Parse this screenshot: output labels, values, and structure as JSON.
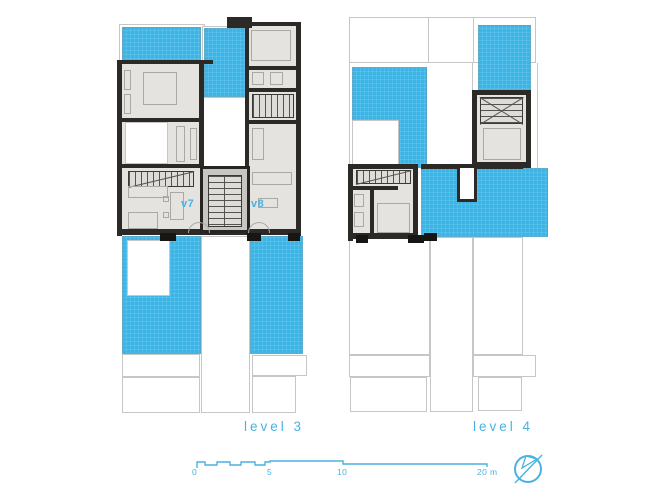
{
  "palette": {
    "terrace_blue": "#3CB4E6",
    "accent": "#49B2E2",
    "wall": "#2B2A27",
    "floor": "#E4E3E0",
    "core": "#C7C6C3",
    "outline": "#C6C6C6",
    "furniture": "#A9A8A4"
  },
  "plans": [
    {
      "label": "level 3",
      "units": [
        {
          "label": "v7"
        },
        {
          "label": "v8"
        }
      ]
    },
    {
      "label": "level 4",
      "units": []
    }
  ],
  "scale_bar": {
    "ticks": [
      {
        "label": "0"
      },
      {
        "label": "5"
      },
      {
        "label": "10"
      },
      {
        "label": "20 m"
      }
    ]
  },
  "icons": {
    "north_arrow": "north-arrow-icon",
    "scale_bar": "scale-bar-profile"
  }
}
